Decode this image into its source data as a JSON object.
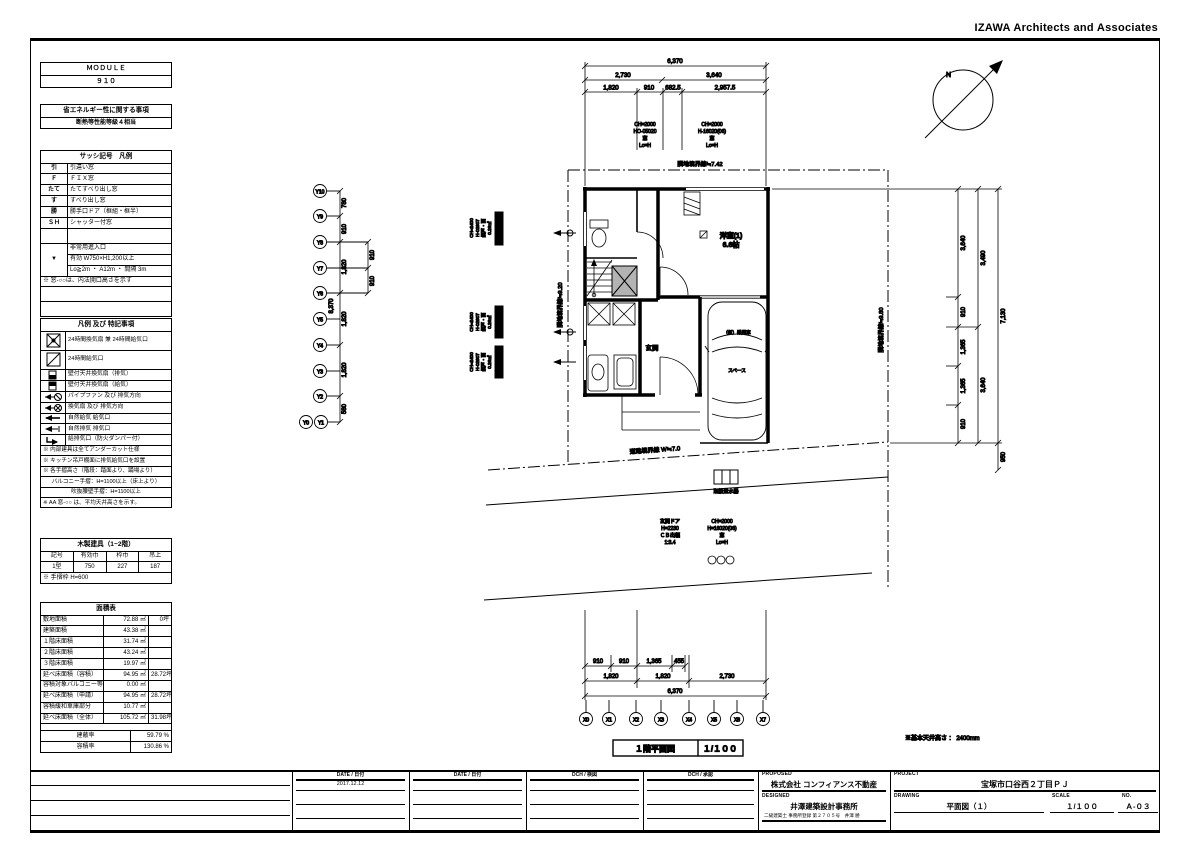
{
  "header": {
    "firm_name": "IZAWA Architects and Associates"
  },
  "module_table": {
    "title": "ＭＯＤＵＬＥ",
    "value": "９１０"
  },
  "energy_table": {
    "title": "省エネルギー性に関する事項",
    "value": "断熱等性能等級４相当"
  },
  "sash_legend": {
    "title": "サッシ記号　凡例",
    "rows": [
      {
        "symbol": "引",
        "label": "引違い窓"
      },
      {
        "symbol": "Ｆ",
        "label": "ＦＩＸ窓"
      },
      {
        "symbol": "たて",
        "label": "たてすべり出し窓"
      },
      {
        "symbol": "す",
        "label": "すべり出し窓"
      },
      {
        "symbol": "勝",
        "label": "勝手口ドア（框組・框半）"
      },
      {
        "symbol": "ＳＨ",
        "label": "シャッター付窓"
      }
    ],
    "emergency": {
      "symbol": "▼",
      "line1": "非常用進入口",
      "line2": "有効 W750×H1,200以上",
      "line3": "Lo≧2m ・ A12m ・ 間隔 3m"
    },
    "note": "※ 窓-○○は、内法開口高さを示す"
  },
  "legend_notes": {
    "title": "凡例 及び 特記事項",
    "rows": [
      {
        "icon": "fan-24h",
        "label": "24時間換気扇 兼 24時間給気口"
      },
      {
        "icon": "supply-24h",
        "label": "24時間給気口"
      },
      {
        "icon": "wall-fan-exhaust",
        "label": "壁付天井換気扇（排気）"
      },
      {
        "icon": "wall-fan-supply",
        "label": "壁付天井換気扇（給気）"
      },
      {
        "icon": "pipe-fan",
        "label": "パイプファン 及び 排気方向"
      },
      {
        "icon": "kitchen-fan",
        "label": "換気扇 及び 排気方向"
      },
      {
        "icon": "natural-supply",
        "label": "自然給気 給気口"
      },
      {
        "icon": "natural-exhaust",
        "label": "自然排気 排気口"
      },
      {
        "icon": "duct",
        "label": "給排気口（防火ダンパー付）"
      }
    ],
    "notes": [
      "※ 内部建具は全てアンダーカット仕様",
      "※ キッチン吊戸棚面に排気給気口を設置",
      "※ 各手摺高さ（階段：踏面より、踊場より）",
      "バルコニー手摺：H=1100以上（床上より）",
      "吹抜腰壁手摺：H=1100以上",
      "※ AA 窓-○○ は、平均天井高さを示す。"
    ]
  },
  "wood_fittings": {
    "title": "木製建具（1~2階）",
    "headers": [
      "記号",
      "有効巾",
      "枠巾",
      "吊上"
    ],
    "values": [
      "1型",
      "750",
      "227",
      "187"
    ],
    "note": "※ 手摺枠 H=600"
  },
  "area_table": {
    "title": "面積表",
    "rows": [
      {
        "label": "敷地面積",
        "sqm": "72.88 ㎡",
        "tsubo": "0坪"
      },
      {
        "label": "建築面積",
        "sqm": "43.38 ㎡",
        "tsubo": ""
      },
      {
        "label": "１階床面積",
        "sqm": "31.74 ㎡",
        "tsubo": ""
      },
      {
        "label": "２階床面積",
        "sqm": "43.24 ㎡",
        "tsubo": ""
      },
      {
        "label": "３階床面積",
        "sqm": "19.97 ㎡",
        "tsubo": ""
      },
      {
        "label": "延べ床面積（容積）",
        "sqm": "94.95 ㎡",
        "tsubo": "28.72坪"
      },
      {
        "label": "容積対象バルコニー等",
        "sqm": "0.00 ㎡",
        "tsubo": ""
      },
      {
        "label": "延べ床面積（申請）",
        "sqm": "94.95 ㎡",
        "tsubo": "28.72坪"
      },
      {
        "label": "容積緩和車庫部分",
        "sqm": "10.77 ㎡",
        "tsubo": ""
      },
      {
        "label": "延べ床面積（全体）",
        "sqm": "105.72 ㎡",
        "tsubo": "31.98坪"
      }
    ],
    "ratios": [
      {
        "label": "建蔽率",
        "value": "59.79 %"
      },
      {
        "label": "容積率",
        "value": "130.86 %"
      }
    ]
  },
  "plan": {
    "title": "１階平面図",
    "scale": "１/１００",
    "ceiling_note": "※基本天井高さ ： 2400mm",
    "compass_label": "N",
    "labels": {
      "room1_name": "洋室(1)",
      "room1_size": "6.6帖",
      "entrance": "玄関",
      "car_line1": "（仮）乗用車",
      "car_line2": "スペース",
      "meter": "既設量水器"
    },
    "boundaries": {
      "top": "隣地境界線≒7.42",
      "left": "隣地境界線≒9.20",
      "right": "隣地境界線≒9.80",
      "road": "道路境界線 W≒7.0"
    },
    "notes": {
      "win_top1": {
        "l1": "CH=2000",
        "l2": "HO-05020",
        "l3": "窓",
        "l4": "Lo=H"
      },
      "win_top2": {
        "l1": "CH=2000",
        "l2": "H-16020(06)",
        "l3": "窓",
        "l4": "Lo=H"
      },
      "win_left": {
        "l1": "CH=2400",
        "l2": "H-02607",
        "l3": "網戸・面",
        "l4": "0.26㎡"
      },
      "door": {
        "l1": "玄関ドア",
        "l2": "H=2230",
        "l3": "ＣＢ出幅",
        "l4": "1:3.4"
      },
      "win_bottom": {
        "l1": "CH=2000",
        "l2": "H=16020(06)",
        "l3": "窓",
        "l4": "Lo=H"
      }
    },
    "grid_x": [
      "X0",
      "X1",
      "X2",
      "X3",
      "X4",
      "X5",
      "X6",
      "X7"
    ],
    "grid_y": [
      "Y10",
      "Y9",
      "Y8",
      "Y7",
      "Y6",
      "Y5",
      "Y4",
      "Y3",
      "Y2",
      "Y1",
      "Y0"
    ],
    "dims": {
      "top_total": "6,370",
      "top_mid": [
        "2,730",
        "3,640"
      ],
      "top_sub": [
        "1,820",
        "910",
        "682.5",
        "2,957.5"
      ],
      "bottom_sub": [
        "910",
        "910",
        "1,365",
        "455"
      ],
      "bottom_mid": [
        "1,820",
        "1,820",
        "2,730"
      ],
      "bottom_total": "6,370",
      "left_segs": [
        "780",
        "910",
        "1,820",
        "1,820",
        "1,820",
        "580"
      ],
      "left_sub": [
        "910",
        "910"
      ],
      "left_total": "8,370",
      "right_segs": [
        "3,640",
        "910",
        "1,365",
        "1,365",
        "910"
      ],
      "right_mid": [
        "3,490",
        "3,640"
      ],
      "right_total": "7,130",
      "right_extra": "950"
    }
  },
  "title_block": {
    "cols": [
      {
        "header": "DATE / 日付",
        "value": "2017.12.12"
      },
      {
        "header": "DATE / 日付",
        "value": ""
      },
      {
        "header": "DCH / 検図",
        "value": ""
      },
      {
        "header": "DCH / 承認",
        "value": ""
      }
    ],
    "proposed_label": "PROPOSED",
    "proposed": "株式会社 コンフィアンス不動産",
    "designed_label": "DESIGNED",
    "designed": "井澤建築設計事務所",
    "designed_sub": "二級建築士 事務所登録 第２７０５号　井澤 勝",
    "project_label": "PROJECT",
    "project": "宝塚市口谷西２丁目ＰＪ",
    "drawing_label": "DRAWING",
    "drawing": "平面図（１）",
    "scale_label": "SCALE",
    "scale": "１/１００",
    "no_label": "NO.",
    "no": "Ａ-０３"
  }
}
